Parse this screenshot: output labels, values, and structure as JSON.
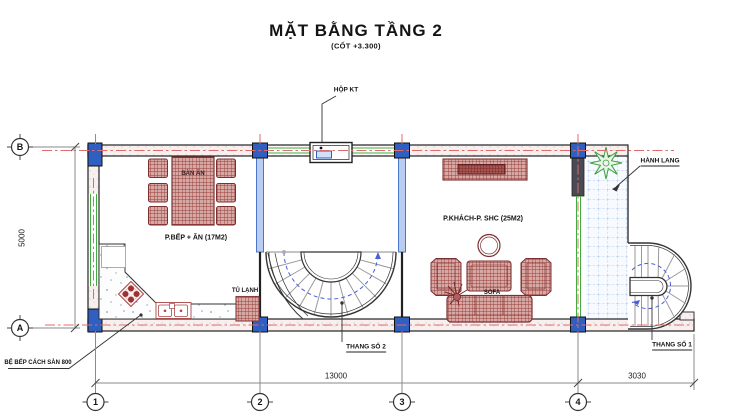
{
  "title": {
    "main": "MẶT BẰNG TẦNG 2",
    "subtitle": "(CỐT +3.300)"
  },
  "rooms": {
    "kitchen": {
      "label": "P.BẾP + ĂN (17M2)"
    },
    "living": {
      "label": "P.KHÁCH-P. SHC (25M2)"
    },
    "corridor": {
      "label": "HÀNH LANG"
    }
  },
  "annotations": {
    "hop_kt": "HỘP KT",
    "dining_table": "BÀN ĂN",
    "fridge": "TỦ LẠNH",
    "sofa": "SOFA",
    "stair2": "THANG SỐ 2",
    "stair1": "THANG SỐ 1",
    "counter_note": "BỆ BẾP CÁCH SÀN 800"
  },
  "dimensions": {
    "horizontal_main": "13000",
    "horizontal_right": "3030",
    "vertical_left": "5000"
  },
  "grid_axes": {
    "vertical": [
      "B",
      "A"
    ],
    "horizontal": [
      "1",
      "2",
      "3",
      "4"
    ]
  },
  "colors": {
    "column": "#2f5fc0",
    "furniture": "#94403c",
    "centerline": "#e06b6b",
    "window": "#3fae3f",
    "tile_grid": "#9ab8e8",
    "stair_guide": "#4b5fd6",
    "plant": "#3f9e3f"
  }
}
